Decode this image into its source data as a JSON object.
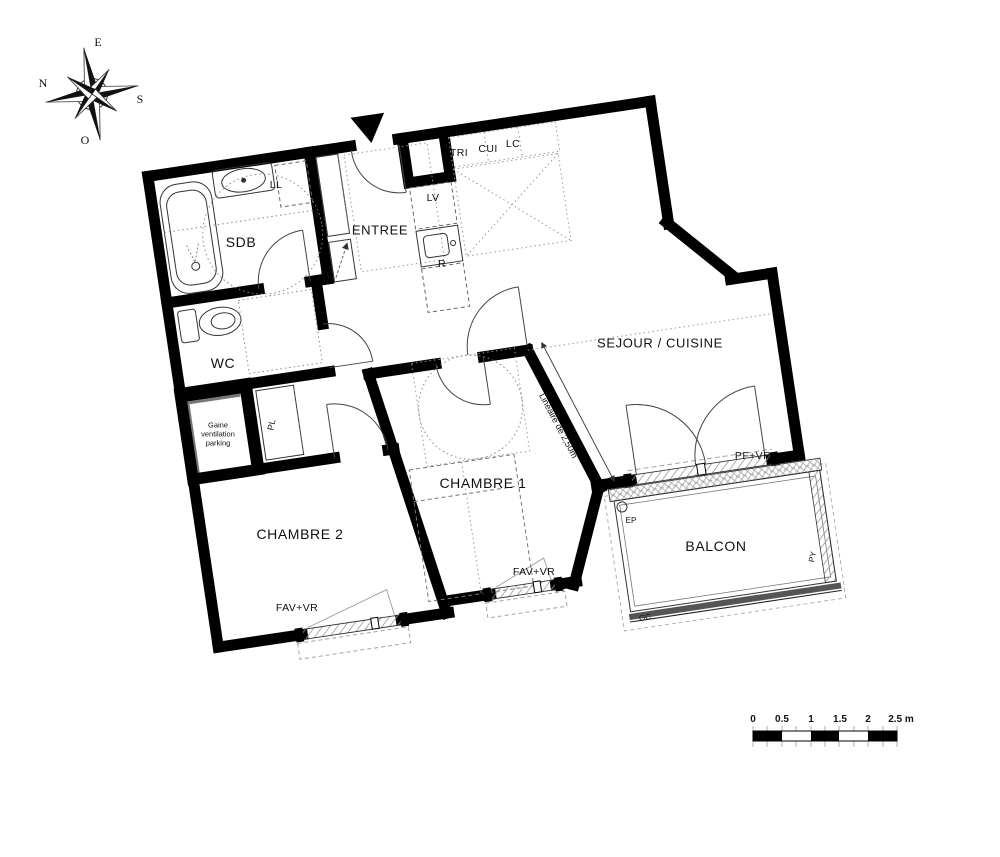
{
  "title": "Plan d'appartement 2 chambres avec balcon",
  "rooms": {
    "sdb": "SDB",
    "wc": "WC",
    "entree": "ENTREE",
    "sejour": "SEJOUR / CUISINE",
    "chambre1": "CHAMBRE 1",
    "chambre2": "CHAMBRE 2",
    "balcon": "BALCON"
  },
  "annotations": {
    "ll": "LL",
    "tri": "TRI",
    "cui": "CUI",
    "lc": "LC",
    "lv": "LV",
    "r": "R",
    "pl_entree": "PL",
    "te": "TE",
    "pl_chambre2": "PL",
    "gaine_line1": "Gaine",
    "gaine_line2": "ventilation",
    "gaine_line3": "parking",
    "lineaire": "Linéaire de 2,50m",
    "pf_vr": "PF+VR",
    "fav_vr_chambre1": "FAV+VR",
    "fav_vr_chambre2": "FAV+VR",
    "ep": "EP",
    "py": "PY",
    "gc": "GC"
  },
  "compass": {
    "east": "E",
    "north": "N",
    "south": "S",
    "west": "O"
  },
  "scale_bar": {
    "ticks": [
      "0",
      "0.5",
      "1",
      "1.5",
      "2",
      "2.5 m"
    ]
  },
  "colors": {
    "wall": "#000000",
    "thin_line": "#222222",
    "dotted": "#888888",
    "guard_rail": "#555555",
    "background": "#ffffff"
  }
}
